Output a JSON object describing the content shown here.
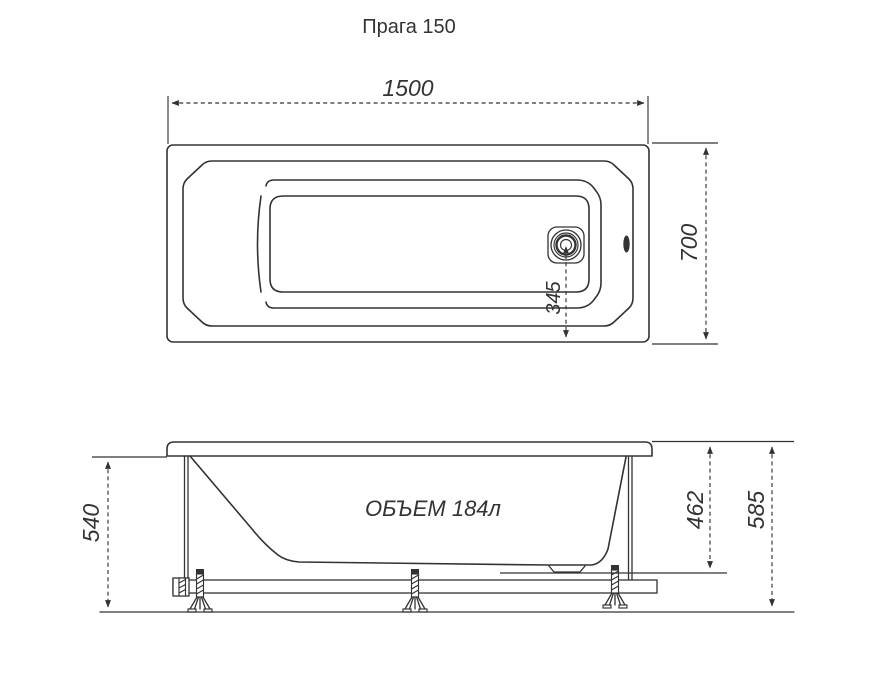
{
  "title": "Прага 150",
  "top_view": {
    "length_label": "1500",
    "width_label": "700",
    "drain_offset_label": "345"
  },
  "side_view": {
    "rim_height_label": "540",
    "shell_depth_label": "462",
    "total_height_label": "585",
    "volume_label": "ОБЪЕМ 184л"
  },
  "colors": {
    "line": "#333333",
    "background": "#ffffff"
  }
}
